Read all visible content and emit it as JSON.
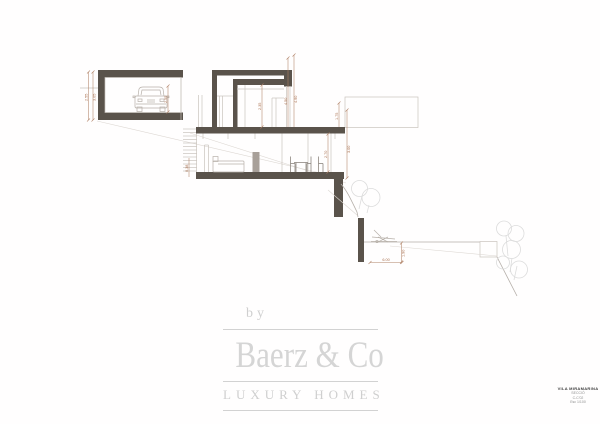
{
  "drawing": {
    "dims": {
      "garage_height_outer": "2.55",
      "garage_height_inner": "3.05",
      "garage_clear": "2.55",
      "upper_clear": "2.35",
      "roof_height_a": "4.50",
      "roof_height_b": "4.90",
      "right_upper": "1.75",
      "living_clear": "2.70",
      "right_total": "3.00",
      "stair_rise": "0.38",
      "terrace_drop": "1.90",
      "terrace_width": "6.00"
    }
  },
  "logo": {
    "by": "by",
    "name": "Baerz & Co",
    "tagline": "LUXURY HOMES"
  },
  "title_block": {
    "project": "VILA MIRAMARINA",
    "sheet": "SECCIÓ",
    "code": "C-C'02",
    "scale": "Esc 1/100"
  },
  "colors": {
    "wall": "#5a534b",
    "dimension": "#a9714f",
    "line": "#c9c3bd",
    "tree": "#dcdcdc",
    "logo_gray": "#d2d2d2"
  }
}
